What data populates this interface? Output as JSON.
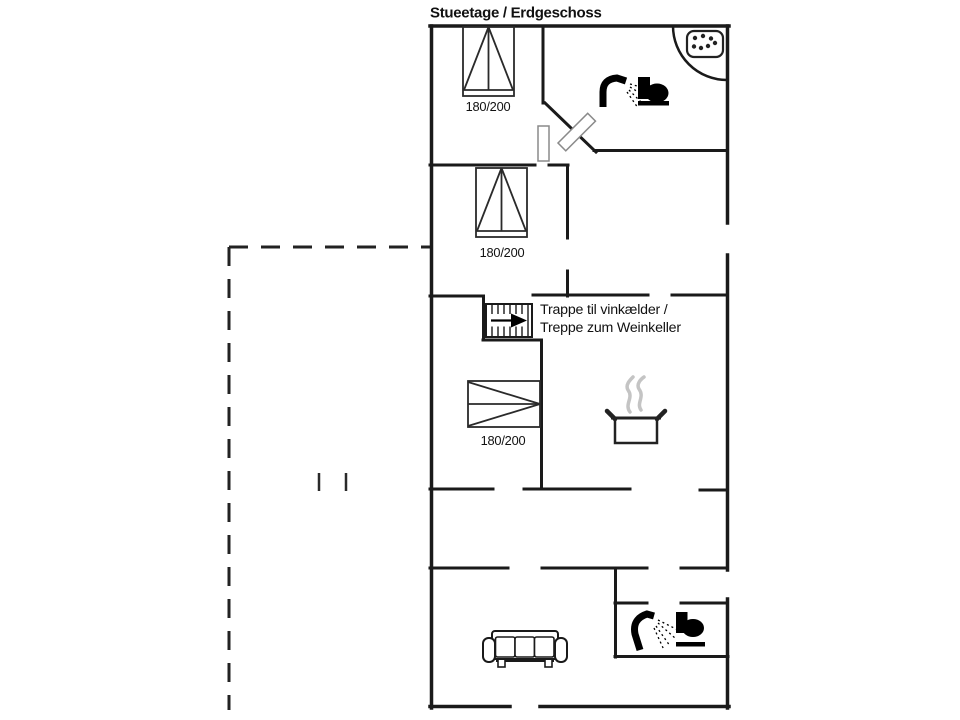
{
  "title": "Stueetage / Erdgeschoss",
  "plan": {
    "colors": {
      "wall": "#1a1a1a",
      "door_leaf_outline": "#8a8a8a",
      "steam": "#c4c4c4",
      "background": "#ffffff"
    },
    "beds": [
      {
        "label": "180/200"
      },
      {
        "label": "180/200"
      },
      {
        "label": "180/200"
      }
    ],
    "stairs": {
      "label_line1": "Trappe til vinkælder /",
      "label_line2": "Treppe zum Weinkeller"
    },
    "icons": [
      "whirlpool-icon",
      "shower-icon",
      "toilet-icon",
      "cooking-pot-icon",
      "sofa-icon",
      "stairs-icon",
      "bed-icon"
    ]
  }
}
